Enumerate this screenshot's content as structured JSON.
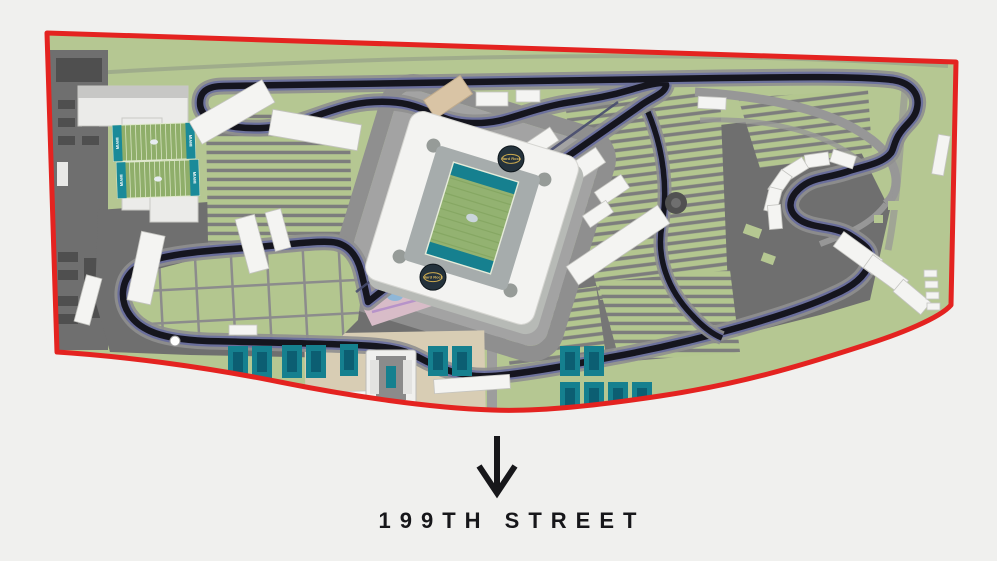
{
  "street_sign": {
    "label": "199TH STREET",
    "arrow_icon": "down-arrow"
  },
  "stadium": {
    "logo_text": "Hard Rock",
    "logo_text_color": "#d9b75c",
    "logo_circle_color": "#24323c"
  },
  "practice_fields": {
    "end_zone_label": "MIAMI"
  },
  "palette": {
    "background": "#f0f0ee",
    "boundary_red": "#e42320",
    "land_green": "#b5c792",
    "asphalt_gray": "#6f6f6f",
    "road_gray": "#8f8f8f",
    "track_dark": "#15151e",
    "track_blue_edge": "#4f55a8",
    "court_teal": "#15808f",
    "court_teal_dark": "#0c5e72",
    "stadium_white": "#f3f3f1",
    "field_green": "#93b271",
    "sand_tan": "#d9c4a5",
    "plaza_pink": "#d8bcc8",
    "label_dark": "#17171a"
  },
  "features": [
    "site-boundary",
    "race-track",
    "pit-lane",
    "hard-rock-stadium",
    "football-field",
    "practice-fields",
    "training-facility",
    "grandstands",
    "parking-lots",
    "tennis-courts",
    "tennis-stadium",
    "plaza",
    "fountain",
    "street-arrow",
    "street-label"
  ]
}
